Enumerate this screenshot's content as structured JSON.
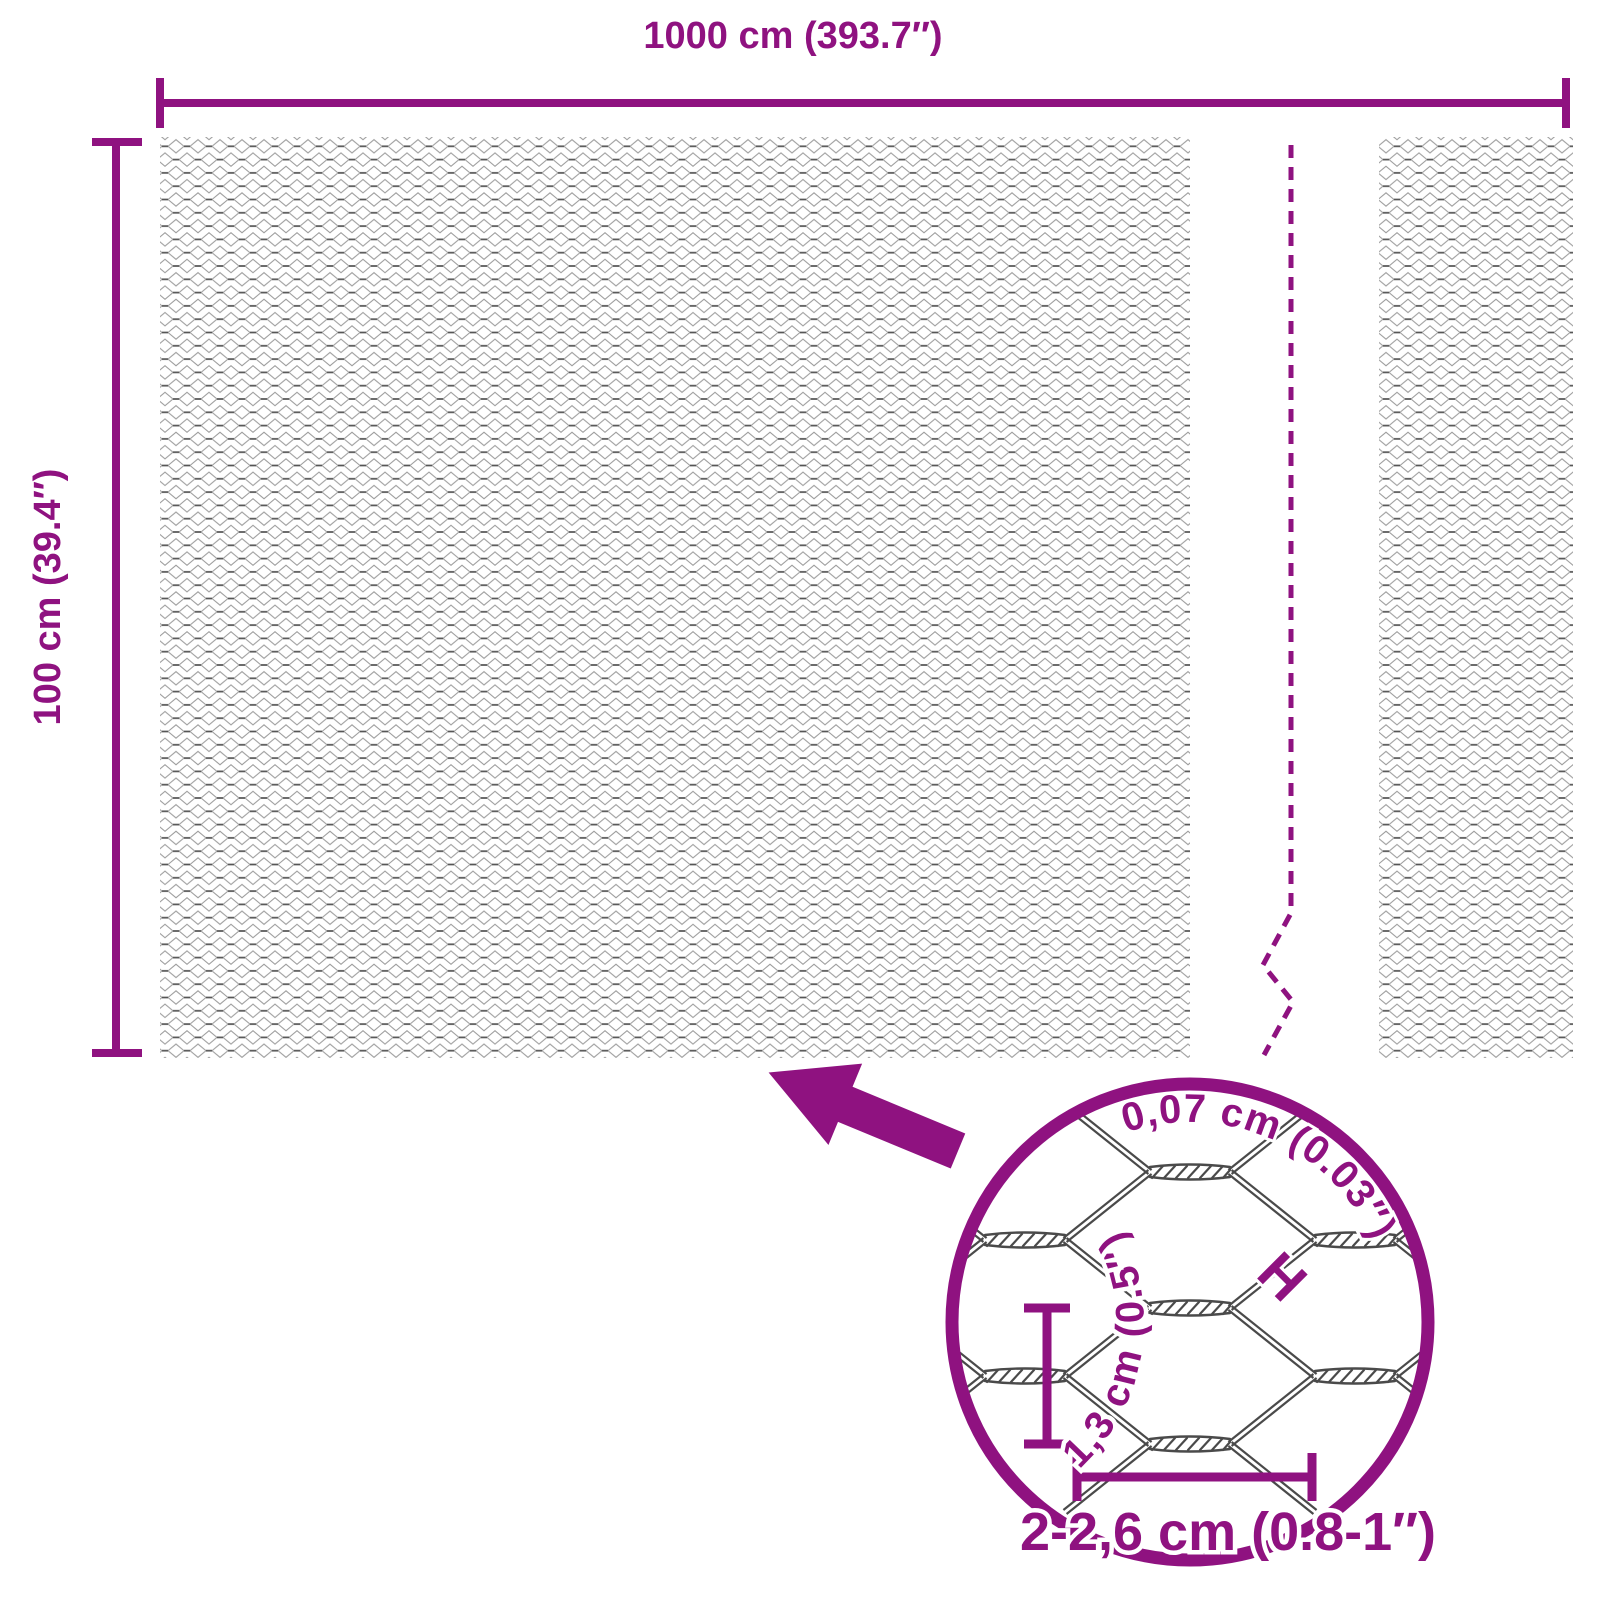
{
  "colors": {
    "accent": "#8F1280",
    "wire_dark": "#4a4a4a",
    "mesh_diagonal": "#9d9d9d",
    "mesh_twist": "#565656"
  },
  "main_diagram": {
    "width_label": "1000 cm (393.7″)",
    "height_label": "100 cm (39.4″)"
  },
  "detail_view": {
    "wire_diameter_label": "0,07 cm (0.03″)",
    "wire_marker_symbol": "H",
    "mesh_height_label": "1,3 cm (0.5″)",
    "mesh_width_label": "2-2,6 cm (0.8-1″)"
  }
}
